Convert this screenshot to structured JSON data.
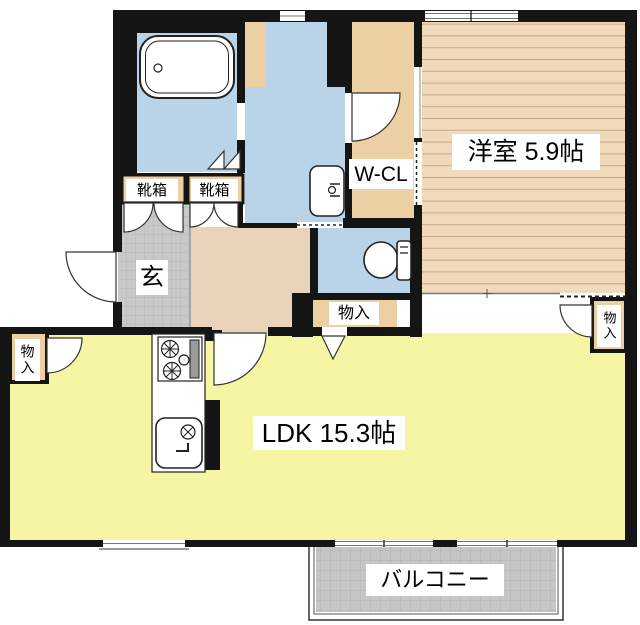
{
  "floorplan": {
    "title": "apartment-floor-plan",
    "rooms": {
      "western_room": "洋室 5.9帖",
      "walk_in_closet": "W-CL",
      "ldk": "LDK 15.3帖",
      "balcony": "バルコニー",
      "entrance": "玄",
      "shoe_box_1": "靴箱",
      "shoe_box_2": "靴箱",
      "storage_left": "物入",
      "storage_center": "物入",
      "storage_right": "物入"
    },
    "fixtures": [
      "bathtub",
      "washbasin",
      "toilet",
      "gas-stove",
      "kitchen-sink"
    ],
    "colors": {
      "wall": "#151515",
      "water_area": "#b9d4e9",
      "ldk_floor": "#f6f5a4",
      "western_floor": "#f1dabb",
      "western_stripe": "#c9ab89",
      "closet_floor": "#eccfa2",
      "hallway_floor": "#e9d3ba",
      "tile_floor": "#c9c9c9",
      "tile_line": "#b7b7b7",
      "balcony_floor": "#c6c6c6",
      "balcony_line": "#b2b2b2",
      "fixture_stroke": "#222222"
    }
  }
}
